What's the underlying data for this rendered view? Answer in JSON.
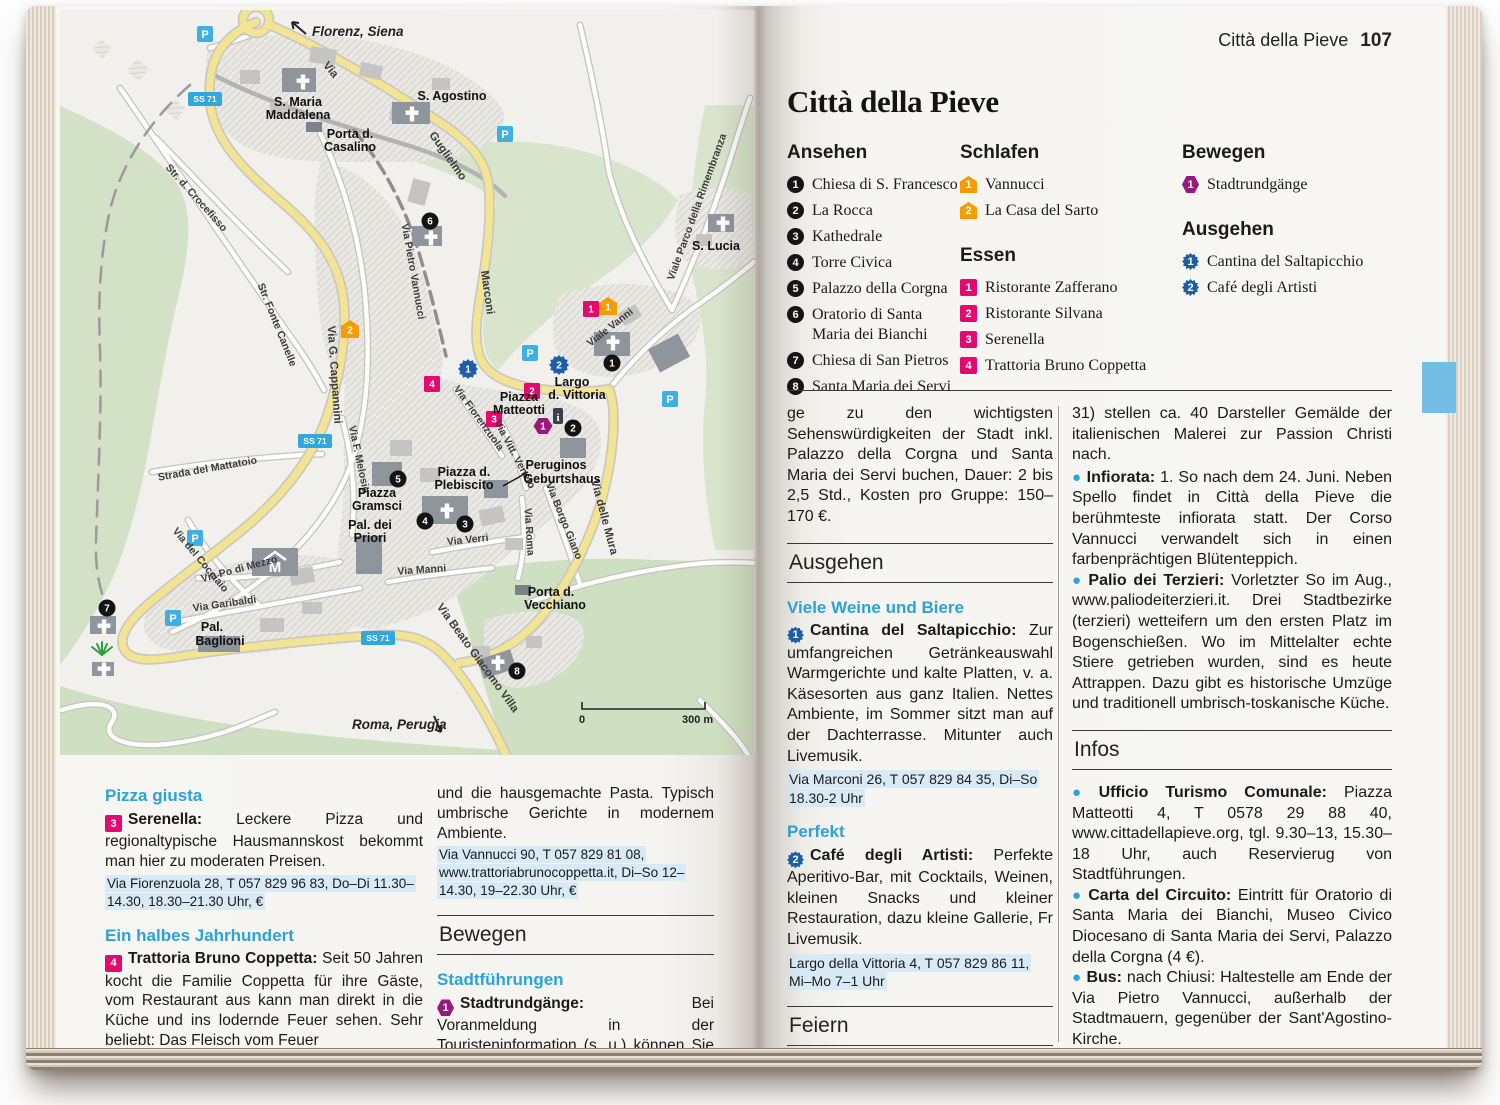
{
  "meta": {
    "running_head": "Città della Pieve",
    "page_number": "107"
  },
  "title": "Città della Pieve",
  "colors": {
    "blue_heading": "#2ba3da",
    "essen": "#e5086e",
    "schlafen": "#f59c00",
    "bewegen": "#99187b",
    "ausgehen": "#1d5ea8",
    "parking": "#3fb0e4",
    "road_badge": "#2fa8e0",
    "address_highlight": "#d8eaf6",
    "bookmark_tab": "#74bde6"
  },
  "legend": {
    "ansehen": {
      "header": "Ansehen",
      "items": [
        {
          "num": "1",
          "label": "Chiesa di S. Francesco"
        },
        {
          "num": "2",
          "label": "La Rocca"
        },
        {
          "num": "3",
          "label": "Kathedrale"
        },
        {
          "num": "4",
          "label": "Torre Civica"
        },
        {
          "num": "5",
          "label": "Palazzo della Corgna"
        },
        {
          "num": "6",
          "label": "Oratorio di Santa Maria dei Bianchi"
        },
        {
          "num": "7",
          "label": "Chiesa di San Pietros"
        },
        {
          "num": "8",
          "label": "Santa Maria dei Servi"
        }
      ]
    },
    "schlafen": {
      "header": "Schlafen",
      "items": [
        {
          "num": "1",
          "label": "Vannucci"
        },
        {
          "num": "2",
          "label": "La Casa del Sarto"
        }
      ]
    },
    "essen": {
      "header": "Essen",
      "items": [
        {
          "num": "1",
          "label": "Ristorante Zafferano"
        },
        {
          "num": "2",
          "label": "Ristorante Silvana"
        },
        {
          "num": "3",
          "label": "Serenella"
        },
        {
          "num": "4",
          "label": "Trattoria Bruno Coppetta"
        }
      ]
    },
    "bewegen": {
      "header": "Bewegen",
      "items": [
        {
          "num": "1",
          "label": "Stadtrundgänge"
        }
      ]
    },
    "ausgehen": {
      "header": "Ausgehen",
      "items": [
        {
          "num": "1",
          "label": "Cantina del Saltapicchio"
        },
        {
          "num": "2",
          "label": "Café degli Artisti"
        }
      ]
    }
  },
  "left_page": {
    "col1": {
      "sub1": "Pizza giusta",
      "e1": {
        "num": "3",
        "lead": "Serenella:",
        "text": "Leckere Pizza und regionaltypische Hausmannskost bekommt man hier zu moderaten Preisen."
      },
      "addr1": "Via Fiorenzuola 28, T 057 829 96 83, Do–Di 11.30–14.30, 18.30–21.30 Uhr, €",
      "sub2": "Ein halbes Jahrhundert",
      "e2": {
        "num": "4",
        "lead": "Trattoria Bruno Coppetta:",
        "text": "Seit 50 Jahren kocht die Familie Coppetta für ihre Gäste, vom Restaurant aus kann man direkt in die Küche und ins lodernde Feuer sehen. Sehr beliebt: Das Fleisch vom Feuer"
      }
    },
    "col2": {
      "p1": "und die hausgemachte Pasta. Typisch umbrische Gerichte in modernem Ambiente.",
      "addr1": "Via Vannucci 90, T 057 829 81 08, www.trattoriabrunocoppetta.it, Di–So 12–14.30, 19–22.30 Uhr, €",
      "section": "Bewegen",
      "sub": "Stadtführungen",
      "e1": {
        "num": "1",
        "lead": "Stadtrundgänge:",
        "text": "Bei Voranmeldung in der Touristeninformation (s. u.) können Sie auch deutschsprachige Stadtrundgän-"
      }
    }
  },
  "right_page": {
    "col1": {
      "p1": "ge zu den wichtigsten Sehenswürdigkeiten der Stadt inkl. Palazzo della Corgna und Santa Maria dei Servi buchen, Dauer: 2 bis 2,5 Std., Kosten pro Gruppe: 150–170 €.",
      "section1": "Ausgehen",
      "sub1": "Viele Weine und Biere",
      "e1": {
        "num": "1",
        "lead": "Cantina del Saltapicchio:",
        "text": "Zur umfangreichen Getränkeauswahl Warmgerichte und kalte Platten, v. a. Käsesorten aus ganz Italien. Nettes Ambiente, im Sommer sitzt man auf der Dachterrasse. Mitunter auch Livemusik."
      },
      "addr1": "Via Marconi 26, T 057 829 84 35, Di–So 18.30-2 Uhr",
      "sub2": "Perfekt",
      "e2": {
        "num": "2",
        "lead": "Café degli Artisti:",
        "text": "Perfekte Aperitivo-Bar, mit Cocktails, Weinen, kleinen Snacks und kleiner Restauration, dazu kleine Gallerie, Fr Livemusik."
      },
      "addr2": "Largo della Vittoria 4, T 057 829 86 11, Mi–Mo 7–1 Uhr",
      "section2": "Feiern",
      "b1": {
        "lead": "Quadri Viventi:",
        "text": "Ostersonntag und -montag. Im Fackel- und Kerzenschein der Taverna del Palazzo Orca (Via Roma"
      }
    },
    "col2": {
      "p1": "31) stellen ca. 40 Darsteller Gemälde der italienischen Malerei zur Passion Christi nach.",
      "b1": {
        "lead": "Infiorata:",
        "text": "1. So nach dem 24. Juni. Neben Spello findet in Città della Pieve die berühmteste infiorata statt. Der Corso Vannucci verwandelt sich in einen farbenprächtigen Blütenteppich."
      },
      "b2": {
        "lead": "Palio dei Terzieri:",
        "text": "Vorletzter So im Aug., www.paliodeiterzieri.it. Drei Stadtbezirke (terzieri) wetteifern um den ersten Platz im Bogenschießen. Wo im Mittelalter echte Stiere getrieben wurden, sind es heute Attrappen. Dazu gibt es historische Umzüge und traditionell umbrisch-toskanische Küche."
      },
      "section": "Infos",
      "b3": {
        "lead": "Ufficio Turismo Comunale:",
        "text": "Piazza Matteotti 4, T 0578 29 88 40, www.cittadellapieve.org, tgl. 9.30–13, 15.30–18 Uhr, auch Reservierug von Stadtführungen."
      },
      "b4": {
        "lead": "Carta del Circuito:",
        "text": "Eintritt für Oratorio di Santa Maria dei Bianchi, Museo Civico Diocesano di Santa Maria dei Servi, Palazzo della Corgna (4 €)."
      },
      "b5": {
        "lead": "Bus:",
        "text": "nach Chiusi: Haltestelle am Ende der Via Pietro Vannucci, außerhalb der Stadtmauern, gegenüber der Sant'Agostino-Kirche."
      }
    }
  },
  "map": {
    "road_badge": "SS 71",
    "parking": "P",
    "museum": "M",
    "info": "i",
    "scale": {
      "start": "0",
      "end": "300 m"
    },
    "directions": [
      "Florenz, Siena",
      "Roma, Perugia"
    ],
    "streets": [
      "Via",
      "Guglielmo",
      "Marconi",
      "Via Pietro Vannucci",
      "Viale Parco della Rimembranza",
      "Viale Vanni",
      "Via G. Cappannini",
      "Str. d. Crocefisso",
      "Str. Fonte Canelle",
      "Strada del Mattatoio",
      "Via F. Melosio",
      "Via del Cocciaio",
      "Via Po di Mezzo",
      "Via Garibaldi",
      "Via Verri",
      "Via Manni",
      "Via Roma",
      "Via Borgo Giano",
      "Via delle Mura",
      "Via Vitt. Veneto",
      "Via Fiorenzuola",
      "Via Beato Giacomo Villa"
    ],
    "places": [
      "S. Maria",
      "Maddalena",
      "Porta d.",
      "Casalino",
      "S. Agostino",
      "S. Lucia",
      "Largo",
      "d. Vittoria",
      "Piazza",
      "Matteotti",
      "Piazza d.",
      "Plebiscito",
      "Piazza",
      "Gramsci",
      "Pal. dei",
      "Priori",
      "Pal.",
      "Baglioni",
      "Peruginos",
      "Geburtshaus",
      "Porta d.",
      "Vecchiano"
    ],
    "markers": {
      "sehen": [
        "1",
        "2",
        "3",
        "4",
        "5",
        "6",
        "7",
        "8"
      ],
      "schlafen": [
        "1",
        "2"
      ],
      "essen": [
        "1",
        "2",
        "3",
        "4"
      ],
      "bewegen": [
        "1"
      ],
      "ausgehen": [
        "1",
        "2"
      ]
    }
  }
}
